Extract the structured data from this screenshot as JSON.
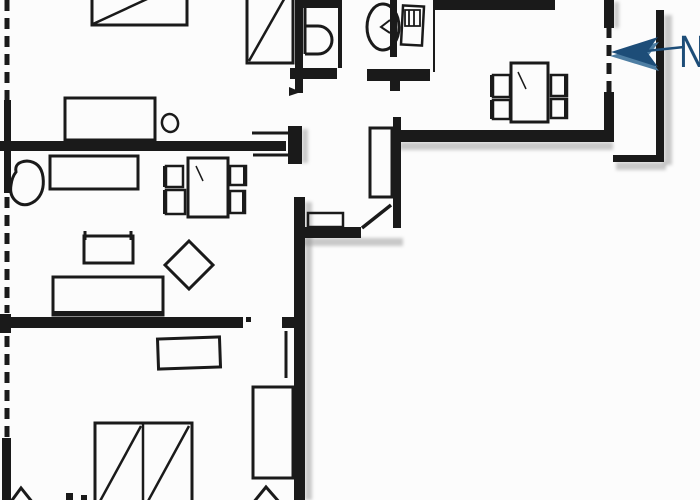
{
  "compass": {
    "label": "N",
    "arrow_direction": "left"
  },
  "colors": {
    "ink": "#1a1a1a",
    "background": "#fcfcfc",
    "compass_blue": "#1d4d78",
    "compass_blue_light": "#4e7ea3",
    "shadow": "#969696"
  },
  "floorplan": {
    "shadows": [
      {
        "x": 305,
        "y": 202,
        "w": 7,
        "h": 298
      },
      {
        "x": 303,
        "y": 238,
        "w": 100,
        "h": 8
      },
      {
        "x": 400,
        "y": 142,
        "w": 213,
        "h": 8
      },
      {
        "x": 664,
        "y": 15,
        "w": 8,
        "h": 150
      },
      {
        "x": 616,
        "y": 162,
        "w": 50,
        "h": 8
      },
      {
        "x": 302,
        "y": 129,
        "w": 6,
        "h": 34
      },
      {
        "x": 614,
        "y": 2,
        "w": 5,
        "h": 26
      }
    ],
    "elements": [
      {
        "name": "wall-left-upper",
        "kind": "frect",
        "x": 4,
        "y": 100,
        "w": 7,
        "h": 93
      },
      {
        "name": "wall-left-junction",
        "kind": "frect",
        "x": 0,
        "y": 314,
        "w": 11,
        "h": 19
      },
      {
        "name": "wall-left-lower",
        "kind": "frect",
        "x": 2,
        "y": 438,
        "w": 9,
        "h": 62
      },
      {
        "name": "wall-living-top",
        "kind": "frect",
        "x": 0,
        "y": 141,
        "w": 286,
        "h": 10
      },
      {
        "name": "wall-door-stub",
        "kind": "frect",
        "x": 288,
        "y": 126,
        "w": 14,
        "h": 38
      },
      {
        "name": "wall-bath-left",
        "kind": "frect",
        "x": 295,
        "y": 0,
        "w": 8,
        "h": 93
      },
      {
        "name": "wall-wing-right",
        "kind": "frect",
        "x": 294,
        "y": 197,
        "w": 11,
        "h": 303
      },
      {
        "name": "wall-bedroom2-top",
        "kind": "frect",
        "x": 3,
        "y": 317,
        "w": 240,
        "h": 11
      },
      {
        "name": "wall-bedroom2-stub",
        "kind": "frect",
        "x": 282,
        "y": 317,
        "w": 20,
        "h": 11
      },
      {
        "name": "wall-wc-divider",
        "kind": "frect",
        "x": 338,
        "y": 0,
        "w": 4,
        "h": 68
      },
      {
        "name": "wall-bath-bottom-left",
        "kind": "frect",
        "x": 290,
        "y": 68,
        "w": 47,
        "h": 11
      },
      {
        "name": "wall-bath-bottom-right",
        "kind": "frect",
        "x": 367,
        "y": 69,
        "w": 63,
        "h": 12
      },
      {
        "name": "wall-kitchen-stub",
        "kind": "frect",
        "x": 390,
        "y": 81,
        "w": 10,
        "h": 10
      },
      {
        "name": "wall-kitchen-partition",
        "kind": "frect",
        "x": 393,
        "y": 117,
        "w": 8,
        "h": 111
      },
      {
        "name": "wall-hall-bottom",
        "kind": "frect",
        "x": 303,
        "y": 227,
        "w": 58,
        "h": 11
      },
      {
        "name": "wall-kitchen-bottom",
        "kind": "frect",
        "x": 397,
        "y": 130,
        "w": 216,
        "h": 12
      },
      {
        "name": "wall-kitchen-top",
        "kind": "frect",
        "x": 433,
        "y": 0,
        "w": 122,
        "h": 10
      },
      {
        "name": "wall-kitchen-right-upper",
        "kind": "frect",
        "x": 604,
        "y": 0,
        "w": 10,
        "h": 28
      },
      {
        "name": "wall-kitchen-right-lower",
        "kind": "frect",
        "x": 604,
        "y": 92,
        "w": 10,
        "h": 50
      },
      {
        "name": "wall-basin",
        "kind": "frect",
        "x": 390,
        "y": 0,
        "w": 7,
        "h": 57
      },
      {
        "name": "balcony-rail-right",
        "kind": "frect",
        "x": 656,
        "y": 10,
        "w": 8,
        "h": 150
      },
      {
        "name": "balcony-rail-bottom",
        "kind": "frect",
        "x": 613,
        "y": 155,
        "w": 51,
        "h": 7
      },
      {
        "name": "door-hinge-dot",
        "kind": "frect",
        "x": 246,
        "y": 317,
        "w": 5,
        "h": 5
      },
      {
        "name": "floor-mark-a",
        "kind": "frect",
        "x": 66,
        "y": 493,
        "w": 7,
        "h": 7
      },
      {
        "name": "floor-mark-b",
        "kind": "frect",
        "x": 81,
        "y": 495,
        "w": 6,
        "h": 5
      },
      {
        "name": "window-left-top",
        "kind": "line",
        "x1": 7,
        "y1": 0,
        "x2": 7,
        "y2": 100,
        "w": 5,
        "dash": "11 7"
      },
      {
        "name": "window-left-living",
        "kind": "line",
        "x1": 7,
        "y1": 197,
        "x2": 7,
        "y2": 313,
        "w": 5,
        "dash": "11 7"
      },
      {
        "name": "window-left-bedroom2",
        "kind": "line",
        "x1": 7,
        "y1": 336,
        "x2": 7,
        "y2": 443,
        "w": 5,
        "dash": "11 7"
      },
      {
        "name": "window-kitchen-right",
        "kind": "line",
        "x1": 609,
        "y1": 27,
        "x2": 609,
        "y2": 92,
        "w": 5,
        "dash": "11 7"
      },
      {
        "name": "counter-edge",
        "kind": "line",
        "x1": 434,
        "y1": 8,
        "x2": 434,
        "y2": 72,
        "w": 2
      },
      {
        "name": "door-marker-upper",
        "kind": "line",
        "x1": 252,
        "y1": 133,
        "x2": 289,
        "y2": 133,
        "w": 3
      },
      {
        "name": "door-marker-lower",
        "kind": "line",
        "x1": 253,
        "y1": 155,
        "x2": 293,
        "y2": 155,
        "w": 3
      },
      {
        "name": "door-marker-arrow",
        "kind": "polygon",
        "points": "289,87 301,92 289,96",
        "fill": "ink"
      },
      {
        "name": "door-leaf-bedroom2",
        "kind": "line",
        "x1": 286,
        "y1": 331,
        "x2": 286,
        "y2": 378,
        "w": 3
      },
      {
        "name": "door-leaf-entry",
        "kind": "line",
        "x1": 362,
        "y1": 228,
        "x2": 391,
        "y2": 205,
        "w": 3.5
      },
      {
        "name": "bed-double-top",
        "kind": "rect",
        "x": 92,
        "y": -20,
        "w": 95,
        "h": 45,
        "sw": 3
      },
      {
        "name": "bed-double-top-diagonal",
        "kind": "line",
        "x1": 93,
        "y1": 24,
        "x2": 186,
        "y2": -19,
        "w": 2.5
      },
      {
        "name": "bed-single-top",
        "kind": "rect",
        "x": 247,
        "y": -15,
        "w": 46,
        "h": 78,
        "sw": 3
      },
      {
        "name": "bed-single-top-diagonal",
        "kind": "line",
        "x1": 249,
        "y1": 61,
        "x2": 291,
        "y2": -13,
        "w": 2.5
      },
      {
        "name": "toilet-cistern",
        "kind": "frect",
        "x": 303,
        "y": 0,
        "w": 37,
        "h": 8
      },
      {
        "name": "toilet-spine",
        "kind": "line",
        "x1": 305,
        "y1": 8,
        "x2": 305,
        "y2": 54,
        "w": 3
      },
      {
        "name": "toilet-bowl",
        "kind": "path",
        "d": "M 305 26 L 318 26 A 14 14 0 0 1 318 54 L 305 54",
        "sw": 3
      },
      {
        "name": "washbasin",
        "kind": "ellipse",
        "cx": 383,
        "cy": 27,
        "rx": 16,
        "ry": 23,
        "sw": 3
      },
      {
        "name": "washbasin-tap",
        "kind": "polyline",
        "points": "390,20 381,27 390,33",
        "sw": 2
      },
      {
        "name": "fridge",
        "kind": "rect",
        "x": 402,
        "y": 6,
        "w": 21,
        "h": 39,
        "sw": 2.5,
        "rotate": 3
      },
      {
        "name": "fridge-hatch",
        "kind": "path",
        "d": "M 405 10 L 420 10 L 420 26 L 405 26 Z M 409 10 L 409 26 M 414 10 L 414 26",
        "sw": 1.8
      },
      {
        "name": "kitchen-table",
        "kind": "rect",
        "x": 511,
        "y": 63,
        "w": 37,
        "h": 59,
        "sw": 3
      },
      {
        "name": "kitchen-table-mark",
        "kind": "line",
        "x1": 518,
        "y1": 72,
        "x2": 526,
        "y2": 89,
        "w": 1.5
      },
      {
        "name": "kitchen-chair-nw",
        "kind": "rect",
        "x": 493,
        "y": 75,
        "w": 17,
        "h": 22,
        "sw": 2.5
      },
      {
        "name": "kitchen-chair-nw-back",
        "kind": "frect",
        "x": 490,
        "y": 75,
        "w": 4,
        "h": 22
      },
      {
        "name": "kitchen-chair-sw",
        "kind": "rect",
        "x": 493,
        "y": 100,
        "w": 17,
        "h": 19,
        "sw": 2.5
      },
      {
        "name": "kitchen-chair-sw-back",
        "kind": "frect",
        "x": 490,
        "y": 100,
        "w": 4,
        "h": 19
      },
      {
        "name": "kitchen-chair-ne",
        "kind": "rect",
        "x": 551,
        "y": 75,
        "w": 16,
        "h": 21,
        "sw": 2.5
      },
      {
        "name": "kitchen-chair-ne-back",
        "kind": "frect",
        "x": 564,
        "y": 75,
        "w": 4,
        "h": 21
      },
      {
        "name": "kitchen-chair-se",
        "kind": "rect",
        "x": 551,
        "y": 99,
        "w": 16,
        "h": 19,
        "sw": 2.5
      },
      {
        "name": "kitchen-chair-se-back",
        "kind": "frect",
        "x": 564,
        "y": 99,
        "w": 4,
        "h": 19
      },
      {
        "name": "bedroom1-table",
        "kind": "rect",
        "x": 65,
        "y": 98,
        "w": 90,
        "h": 42,
        "sw": 3
      },
      {
        "name": "bedroom1-stool",
        "kind": "ellipse",
        "cx": 170,
        "cy": 123,
        "rx": 8,
        "ry": 9,
        "sw": 2.5,
        "rotate": -15
      },
      {
        "name": "armchair",
        "kind": "path",
        "d": "M 16 172 Q 14 162 27 161 Q 41 162 43 177 Q 45 193 35 201 Q 25 208 17 202 Q 9 196 11 185 Q 12 177 16 172 Z",
        "sw": 3
      },
      {
        "name": "sideboard",
        "kind": "rect",
        "x": 50,
        "y": 156,
        "w": 88,
        "h": 33,
        "sw": 3
      },
      {
        "name": "living-table",
        "kind": "rect",
        "x": 188,
        "y": 158,
        "w": 40,
        "h": 59,
        "sw": 3
      },
      {
        "name": "living-table-mark",
        "kind": "line",
        "x1": 196,
        "y1": 166,
        "x2": 203,
        "y2": 181,
        "w": 1.5
      },
      {
        "name": "living-chair-nw",
        "kind": "rect",
        "x": 166,
        "y": 166,
        "w": 17,
        "h": 21,
        "sw": 2.5
      },
      {
        "name": "living-chair-nw-back",
        "kind": "frect",
        "x": 163,
        "y": 166,
        "w": 4,
        "h": 21
      },
      {
        "name": "living-chair-sw",
        "kind": "rect",
        "x": 166,
        "y": 190,
        "w": 19,
        "h": 24,
        "sw": 2.5
      },
      {
        "name": "living-chair-sw-back",
        "kind": "frect",
        "x": 163,
        "y": 190,
        "w": 4,
        "h": 24
      },
      {
        "name": "living-chair-ne",
        "kind": "rect",
        "x": 230,
        "y": 166,
        "w": 16,
        "h": 19,
        "sw": 2.5
      },
      {
        "name": "living-chair-ne-back",
        "kind": "frect",
        "x": 243,
        "y": 166,
        "w": 4,
        "h": 19
      },
      {
        "name": "living-chair-se",
        "kind": "rect",
        "x": 230,
        "y": 191,
        "w": 15,
        "h": 22,
        "sw": 2.5
      },
      {
        "name": "living-chair-se-back",
        "kind": "frect",
        "x": 242,
        "y": 191,
        "w": 4,
        "h": 22
      },
      {
        "name": "side-table",
        "kind": "rect",
        "x": 84,
        "y": 236,
        "w": 49,
        "h": 27,
        "sw": 3
      },
      {
        "name": "side-table-tick-left",
        "kind": "line",
        "x1": 85,
        "y1": 231,
        "x2": 85,
        "y2": 240,
        "w": 3
      },
      {
        "name": "side-table-tick-right",
        "kind": "line",
        "x1": 131,
        "y1": 231,
        "x2": 131,
        "y2": 240,
        "w": 3
      },
      {
        "name": "lounge-chair-diamond",
        "kind": "polygon",
        "points": "189,241 213,265 189,289 165,265",
        "sw": 3,
        "fill": "none"
      },
      {
        "name": "sofa",
        "kind": "rect",
        "x": 53,
        "y": 277,
        "w": 110,
        "h": 38,
        "sw": 3
      },
      {
        "name": "sofa-front-edge",
        "kind": "line",
        "x1": 54,
        "y1": 313,
        "x2": 162,
        "y2": 313,
        "w": 4
      },
      {
        "name": "desk",
        "kind": "rect",
        "x": 158,
        "y": 338,
        "w": 62,
        "h": 30,
        "sw": 3,
        "rotate": -2
      },
      {
        "name": "wardrobe",
        "kind": "rect",
        "x": 253,
        "y": 387,
        "w": 40,
        "h": 91,
        "sw": 3
      },
      {
        "name": "bed-double-bottom",
        "kind": "rect",
        "x": 95,
        "y": 423,
        "w": 97,
        "h": 82,
        "sw": 3
      },
      {
        "name": "bed-divider",
        "kind": "line",
        "x1": 143,
        "y1": 423,
        "x2": 143,
        "y2": 505,
        "w": 2.5
      },
      {
        "name": "bed-diagonal-left",
        "kind": "line",
        "x1": 99,
        "y1": 503,
        "x2": 141,
        "y2": 426,
        "w": 2.5
      },
      {
        "name": "bed-diagonal-right",
        "kind": "line",
        "x1": 147,
        "y1": 503,
        "x2": 189,
        "y2": 426,
        "w": 2.5
      },
      {
        "name": "lamp-left",
        "kind": "polyline",
        "points": "10,503 21,488 33,503",
        "sw": 3
      },
      {
        "name": "lamp-right",
        "kind": "polyline",
        "points": "253,503 266,487 280,503",
        "sw": 3
      },
      {
        "name": "hall-sideboard",
        "kind": "rect",
        "x": 308,
        "y": 213,
        "w": 35,
        "h": 14,
        "sw": 2.5
      },
      {
        "name": "hall-wardrobe",
        "kind": "rect",
        "x": 370,
        "y": 128,
        "w": 22,
        "h": 69,
        "sw": 3
      },
      {
        "name": "compass-arrow-highlight",
        "kind": "polygon",
        "points": "610,56 659,42 648,56 659,71",
        "fill": "#4e7ea3"
      },
      {
        "name": "compass-arrow",
        "kind": "polygon",
        "points": "611,52 658,37 647,52 658,67",
        "fill": "#1d4d78"
      },
      {
        "name": "compass-shaft",
        "kind": "line",
        "x1": 646,
        "y1": 51,
        "x2": 684,
        "y2": 47,
        "w": 2.5,
        "color": "#1d4d78"
      }
    ]
  }
}
